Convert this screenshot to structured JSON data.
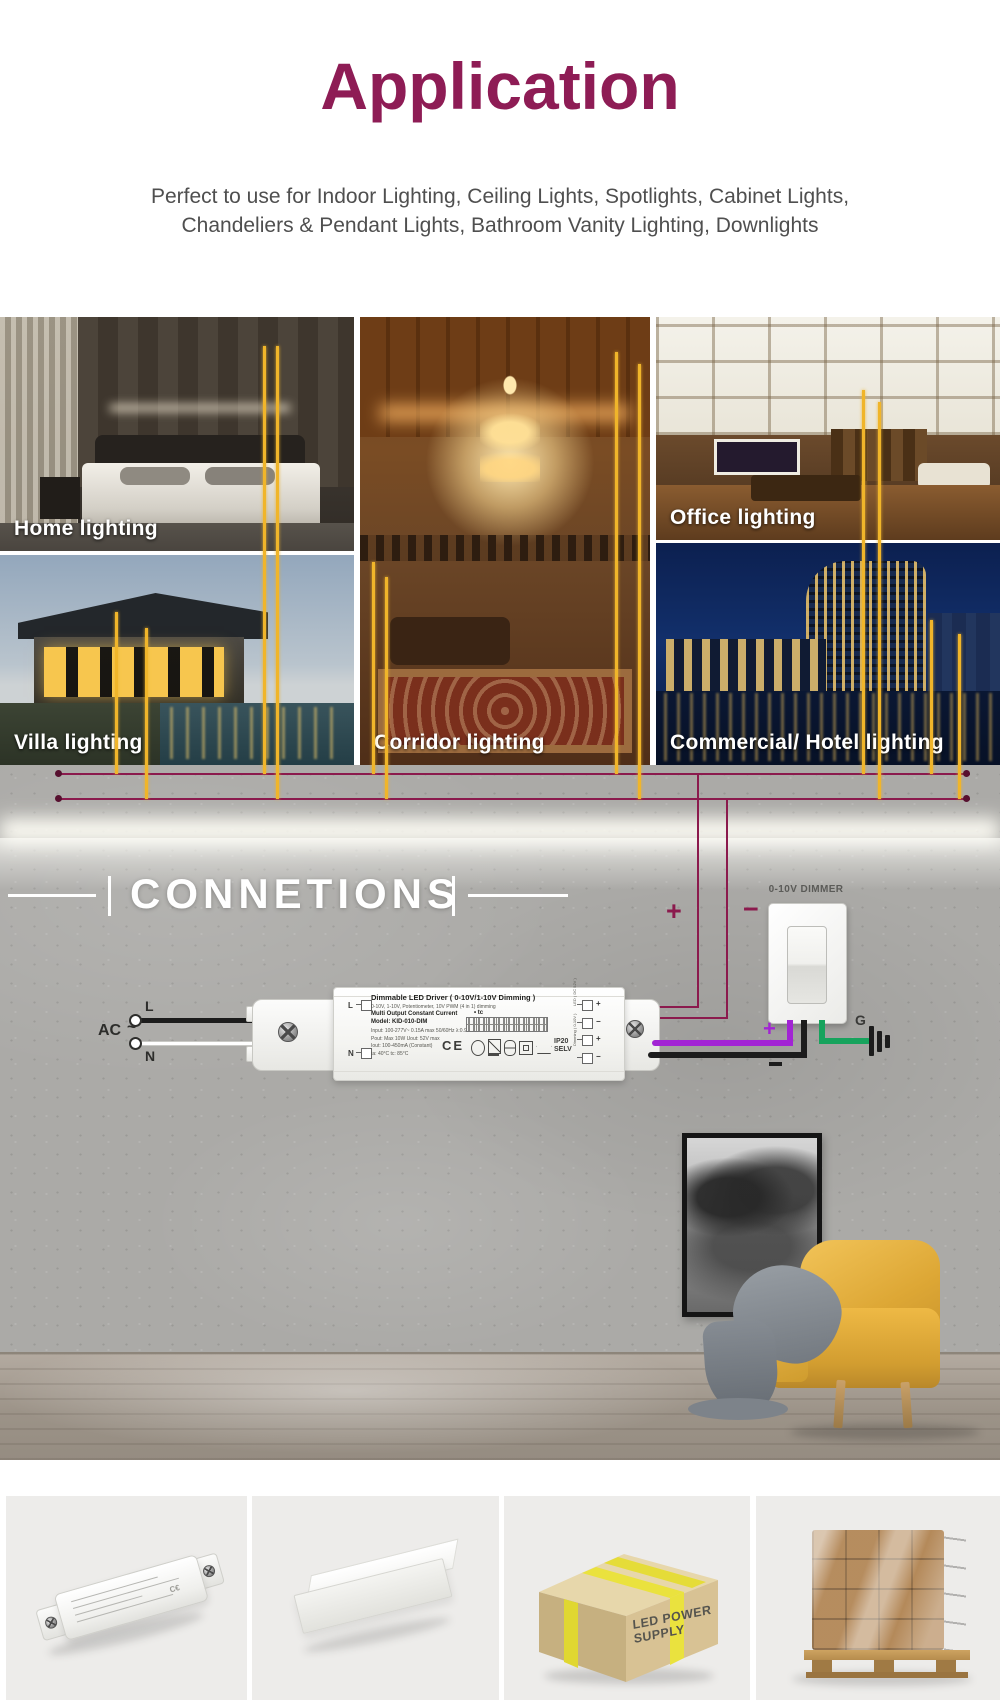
{
  "colors": {
    "accent": "#8E1C55",
    "wire_magenta": "#8B1A4D",
    "wire_yellow": "#F0B52A",
    "wire_purple": "#A224D4",
    "wire_green": "#17A35D",
    "wire_black": "#1C1C1C"
  },
  "header": {
    "title": "Application",
    "subtitle1": "Perfect to use for Indoor Lighting, Ceiling Lights, Spotlights, Cabinet Lights,",
    "subtitle2": "Chandeliers & Pendant Lights, Bathroom Vanity Lighting, Downlights"
  },
  "gallery": {
    "labels": [
      "Home lighting",
      "Office lighting",
      "Villa lighting",
      "Corridor lighting",
      "Commercial/ Hotel lighting"
    ]
  },
  "connections": {
    "heading": "CONNETIONS",
    "dimmer_label": "0-10V DIMMER",
    "ac": "AC",
    "tilde": "~",
    "l": "L",
    "n": "N",
    "g": "G",
    "plus_top": "+",
    "minus_top": "−",
    "dim_plus": "+"
  },
  "driver": {
    "title": "Dimmable LED Driver ( 0-10V/1-10V Dimming )",
    "subtitle": "0-10V, 1-10V, Potentiometer, 10V PWM (4 in 1) dimming",
    "multi": "Multi Output Constant Current",
    "tc": "tc",
    "model": "Model: KID-010-DIM",
    "input": "Input: 100-277V~ 0.15A max 50/60Hz λ:0.9",
    "pout": "Pout: Max 10W  Uout: 52V max",
    "iout": "Iout: 100-450mA (Constant)",
    "temps": "ta: 40°C   tc: 85°C",
    "ce": "CE",
    "ip": "IP20",
    "selv": "SELV",
    "term_l": "L",
    "term_n": "N",
    "terminals": [
      "+",
      "−",
      "+",
      "−"
    ],
    "side_led": "LED ( DC 52V )",
    "side_dim": "Dimming ( 0-10V )"
  },
  "products": {
    "carton_text": "LED POWER SUPPLY"
  }
}
